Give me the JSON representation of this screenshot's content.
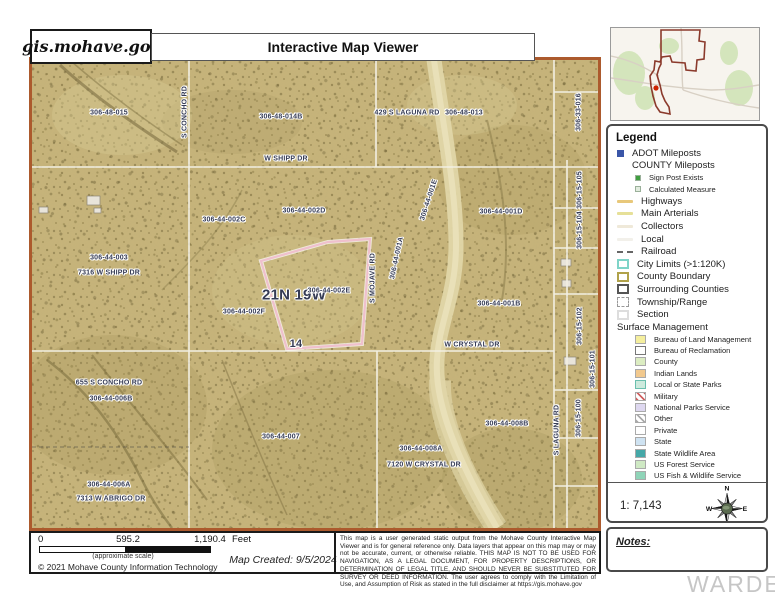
{
  "header": {
    "site": "gis.mohave.gov",
    "title": "Interactive Map Viewer"
  },
  "map": {
    "labels": [
      {
        "text": "306-48-015",
        "x": 77,
        "y": 53
      },
      {
        "text": "306-48-014B",
        "x": 249,
        "y": 57
      },
      {
        "text": "429 S LAGUNA RD",
        "x": 375,
        "y": 53
      },
      {
        "text": "306-48-013",
        "x": 432,
        "y": 53
      },
      {
        "text": "306-33-016",
        "x": 547,
        "y": 52,
        "rot": -90
      },
      {
        "text": "W SHIPP DR",
        "x": 254,
        "y": 99
      },
      {
        "text": "S CONCHO RD",
        "x": 153,
        "y": 52,
        "rot": -90
      },
      {
        "text": "306-44-002C",
        "x": 192,
        "y": 160
      },
      {
        "text": "306-44-002D",
        "x": 272,
        "y": 151
      },
      {
        "text": "306-44-003",
        "x": 77,
        "y": 198
      },
      {
        "text": "7316 W SHIPP DR",
        "x": 77,
        "y": 213
      },
      {
        "text": "21N 19W",
        "x": 262,
        "y": 235,
        "size": 15
      },
      {
        "text": "306-44-002E",
        "x": 297,
        "y": 231
      },
      {
        "text": "306-44-002F",
        "x": 212,
        "y": 252
      },
      {
        "text": "14",
        "x": 264,
        "y": 284,
        "size": 11
      },
      {
        "text": "S MOJAVE RD",
        "x": 341,
        "y": 218,
        "rot": -90
      },
      {
        "text": "306-44-001A",
        "x": 365,
        "y": 198,
        "rot": -78
      },
      {
        "text": "306-44-001E",
        "x": 397,
        "y": 140,
        "rot": -72
      },
      {
        "text": "306-44-001D",
        "x": 469,
        "y": 152
      },
      {
        "text": "306-44-001B",
        "x": 467,
        "y": 244
      },
      {
        "text": "306-15-105",
        "x": 548,
        "y": 130,
        "rot": -90
      },
      {
        "text": "306-15-104",
        "x": 548,
        "y": 170,
        "rot": -90
      },
      {
        "text": "W CRYSTAL DR",
        "x": 440,
        "y": 285
      },
      {
        "text": "306-15-102",
        "x": 548,
        "y": 266,
        "rot": -90
      },
      {
        "text": "306-15-101",
        "x": 561,
        "y": 309,
        "rot": -90
      },
      {
        "text": "306-15-100",
        "x": 547,
        "y": 358,
        "rot": -90
      },
      {
        "text": "S LAGUNA RD",
        "x": 525,
        "y": 370,
        "rot": -90
      },
      {
        "text": "655 S CONCHO RD",
        "x": 77,
        "y": 323
      },
      {
        "text": "306-44-006B",
        "x": 79,
        "y": 339
      },
      {
        "text": "306-44-007",
        "x": 249,
        "y": 377
      },
      {
        "text": "306-44-006A",
        "x": 77,
        "y": 425
      },
      {
        "text": "7313 W ABRIGO DR",
        "x": 79,
        "y": 439
      },
      {
        "text": "306-44-008A",
        "x": 389,
        "y": 389
      },
      {
        "text": "7120 W CRYSTAL DR",
        "x": 392,
        "y": 405
      },
      {
        "text": "306-44-008B",
        "x": 475,
        "y": 364
      }
    ],
    "selected_parcel_color": "#efc0cd",
    "border_color": "#ac5a2d"
  },
  "overview": {
    "boundary_color": "#8b3a2c",
    "marker_color": "#cc2200"
  },
  "legend": {
    "title": "Legend",
    "items": [
      {
        "label": "ADOT Mileposts",
        "swatch": "sq",
        "color": "#3a56a8"
      },
      {
        "label": "COUNTY Mileposts",
        "swatch": "none"
      },
      {
        "label": "Sign Post Exists",
        "swatch": "sq-sm",
        "color": "#3f9e3f",
        "indent": true
      },
      {
        "label": "Calculated Measure",
        "swatch": "sq-sm",
        "color": "#e2ecdf",
        "indent": true
      },
      {
        "label": "Highways",
        "swatch": "line",
        "color": "#e8c87a"
      },
      {
        "label": "Main Arterials",
        "swatch": "line",
        "color": "#e6e098"
      },
      {
        "label": "Collectors",
        "swatch": "line",
        "color": "#efe9d9"
      },
      {
        "label": "Local",
        "swatch": "line",
        "color": "#f2f0ea"
      },
      {
        "label": "Railroad",
        "swatch": "rail"
      },
      {
        "label": "City Limits (>1:120K)",
        "swatch": "box",
        "color": "#7fd4c8"
      },
      {
        "label": "County Boundary",
        "swatch": "box",
        "color": "#b0a24a"
      },
      {
        "label": "Surrounding Counties",
        "swatch": "box",
        "color": "#555555"
      },
      {
        "label": "Township/Range",
        "swatch": "box-dash"
      },
      {
        "label": "Section",
        "swatch": "box",
        "color": "#dddddd"
      }
    ],
    "surface_title": "Surface Management",
    "surface_items": [
      {
        "label": "Bureau of Land Management",
        "color": "#f5ef9e"
      },
      {
        "label": "Bureau of Reclamation",
        "color": "#ffffff",
        "border": "#777777"
      },
      {
        "label": "County",
        "color": "#dcedc2"
      },
      {
        "label": "Indian Lands",
        "color": "#f2c98e"
      },
      {
        "label": "Local or State Parks",
        "color": "#cdeadd",
        "border": "#6bbfae"
      },
      {
        "label": "Military",
        "hatch": "#d06060"
      },
      {
        "label": "National Parks Service",
        "color": "#ded8f0"
      },
      {
        "label": "Other",
        "hatch": "#aaaaaa"
      },
      {
        "label": "Private",
        "color": "#ffffff"
      },
      {
        "label": "State",
        "color": "#cfe3f2"
      },
      {
        "label": "State Wildlife Area",
        "color": "#45a8a8"
      },
      {
        "label": "US Forest Service",
        "color": "#cfe9c4"
      },
      {
        "label": "US Fish & Wildlife Service",
        "color": "#8fd4b8"
      }
    ],
    "scale_ratio": "1: 7,143",
    "compass": {
      "n": "N",
      "s": "S",
      "e": "E",
      "w": "W"
    }
  },
  "notes": {
    "label": "Notes:"
  },
  "scalebar": {
    "start": "0",
    "mid": "595.2",
    "end": "1,190.4",
    "unit": "Feet",
    "approx": "(approximate scale)",
    "copyright": "© 2021 Mohave County Information Technology",
    "created": "Map Created: 9/5/2024"
  },
  "disclaimer": "This map is a user generated static output from the Mohave County Interactive Map Viewer and is for general reference only. Data layers that appear on this map may or may not be accurate, current, or otherwise reliable. THIS MAP IS NOT TO BE USED FOR NAVIGATION, AS A LEGAL DOCUMENT, FOR PROPERTY DESCRIPTIONS, OR DETERMINATION OF LEGAL TITLE, AND SHOULD NEVER BE SUBSTITUTED FOR SURVEY OR DEED INFORMATION. The user agrees to comply with the Limitation of Use, and Assumption of Risk as stated in the full disclaimer at https://gis.mohave.gov",
  "watermark": "WARDEX"
}
